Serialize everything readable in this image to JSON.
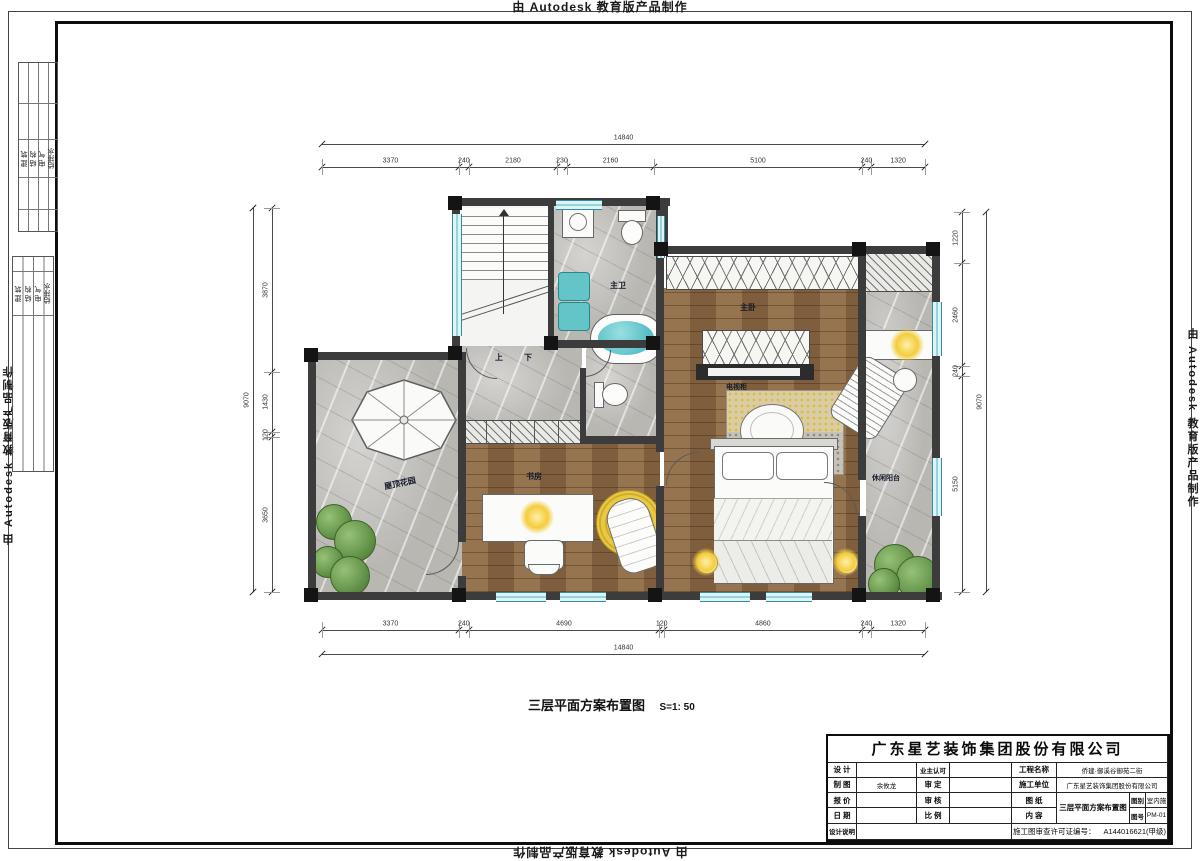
{
  "banner": {
    "text": "由 Autodesk 教育版产品制作"
  },
  "stamps": {
    "disciplines": [
      "建 筑",
      "结 构",
      "电 气",
      "给排水"
    ]
  },
  "plan": {
    "rooms": {
      "master_bath": "主卫",
      "master_bed": "主卧",
      "tv_cabinet": "电视柜",
      "study": "书房",
      "roof_garden": "屋顶花园",
      "balcony": "休闲阳台",
      "stair_up": "上",
      "stair_down": "下"
    }
  },
  "dimensions": {
    "top": {
      "overall": "14840",
      "segments": [
        3370,
        240,
        2180,
        230,
        2160,
        5100,
        240,
        1320
      ]
    },
    "bottom": {
      "overall": "14840",
      "segments": [
        3370,
        240,
        4690,
        120,
        4860,
        240,
        1320
      ]
    },
    "left": {
      "overall": "9070",
      "segments": [
        3870,
        1430,
        120,
        3650
      ]
    },
    "right": {
      "overall": "9070",
      "segments": [
        1220,
        2460,
        240,
        5150
      ]
    }
  },
  "caption": {
    "title": "三层平面方案布置图",
    "scale": "S=1: 50"
  },
  "title_block": {
    "company": "广东星艺装饰集团股份有限公司",
    "design_label": "设 计",
    "owner_label": "业主认可",
    "project_label": "工程名称",
    "project_value": "侨建·御溪谷御苑二街",
    "draft_label": "制 图",
    "draft_value": "余攸龙",
    "approve_label": "审 定",
    "contractor_label": "施工单位",
    "contractor_value": "广东星艺装饰集团股份有限公司",
    "quote_label": "报 价",
    "check_label": "审 核",
    "drawing_label": "图 纸",
    "content_label": "内 容",
    "content_value": "三层平面方案布置图",
    "category_label": "图别",
    "category_value": "室内施",
    "number_label": "图号",
    "number_value": "PM-01",
    "date_label": "日 期",
    "scale_label": "比 例",
    "note_label": "设计说明",
    "permit_label": "施工图审查许可证编号：",
    "permit_value": "A144016621(甲级)"
  }
}
